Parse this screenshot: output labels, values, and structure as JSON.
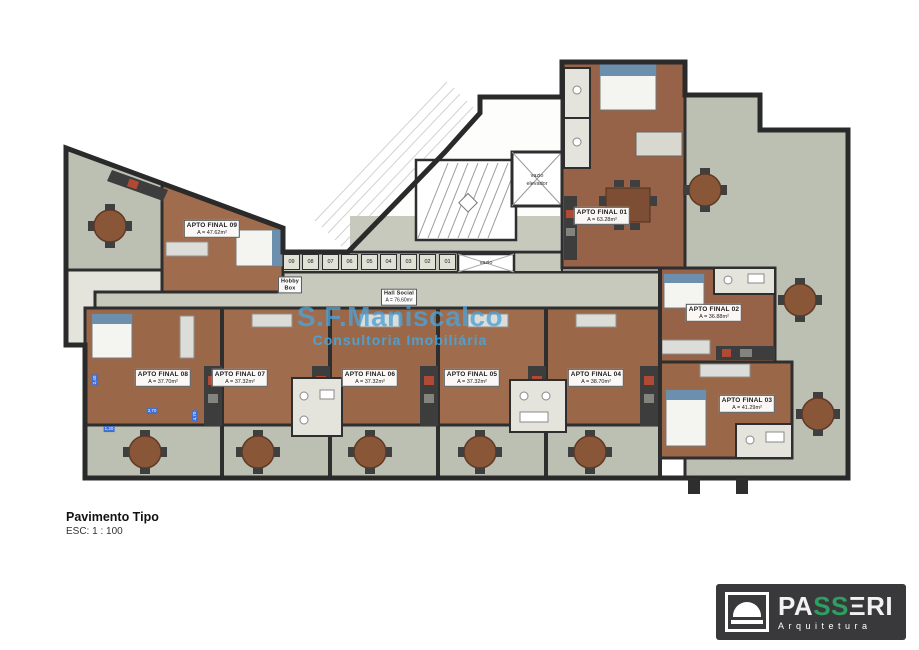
{
  "drawing": {
    "title": "Pavimento Tipo",
    "scale": "ESC: 1 : 100",
    "watermark": {
      "line1": "S.F.Maniscalco",
      "line2": "Consultoria Imobiliária"
    },
    "hall": {
      "name": "Hall Social",
      "area": "A = 76.60m²"
    },
    "labels": {
      "hobby_line1": "Hobby",
      "hobby_line2": "Box",
      "vazio": "vazio",
      "vazio_elevador_line1": "vazio",
      "vazio_elevador_line2": "elevador"
    },
    "hobby_boxes": [
      "09",
      "08",
      "07",
      "06",
      "05",
      "04",
      "03",
      "02",
      "01"
    ],
    "apartments": [
      {
        "id": "apto-09",
        "name": "APTO FINAL 09",
        "area": "A = 47.62m²"
      },
      {
        "id": "apto-01",
        "name": "APTO FINAL 01",
        "area": "A = 63.28m²"
      },
      {
        "id": "apto-02",
        "name": "APTO FINAL 02",
        "area": "A = 36.88m²"
      },
      {
        "id": "apto-03",
        "name": "APTO FINAL 03",
        "area": "A = 41.29m²"
      },
      {
        "id": "apto-08",
        "name": "APTO FINAL 08",
        "area": "A = 37.70m²"
      },
      {
        "id": "apto-07",
        "name": "APTO FINAL 07",
        "area": "A = 37.32m²"
      },
      {
        "id": "apto-06",
        "name": "APTO FINAL 06",
        "area": "A = 37.32m²"
      },
      {
        "id": "apto-05",
        "name": "APTO FINAL 05",
        "area": "A = 37.32m²"
      },
      {
        "id": "apto-04",
        "name": "APTO FINAL 04",
        "area": "A = 38.70m²"
      }
    ],
    "dimensions": [
      "2,40",
      "3,70",
      "1,20",
      "4,70"
    ],
    "colors": {
      "wall": "#2e2e2e",
      "wood": "#9c6a4d",
      "terrace": "#bcc0b2",
      "watermark_blue": "#4ca3d8",
      "logo_green": "#2f9e62",
      "dim_blue": "#3f6fd4"
    }
  },
  "logo": {
    "letters": [
      "P",
      "A",
      "S",
      "S",
      "Ξ",
      "R",
      "I"
    ],
    "subtitle": "Arquitetura"
  }
}
